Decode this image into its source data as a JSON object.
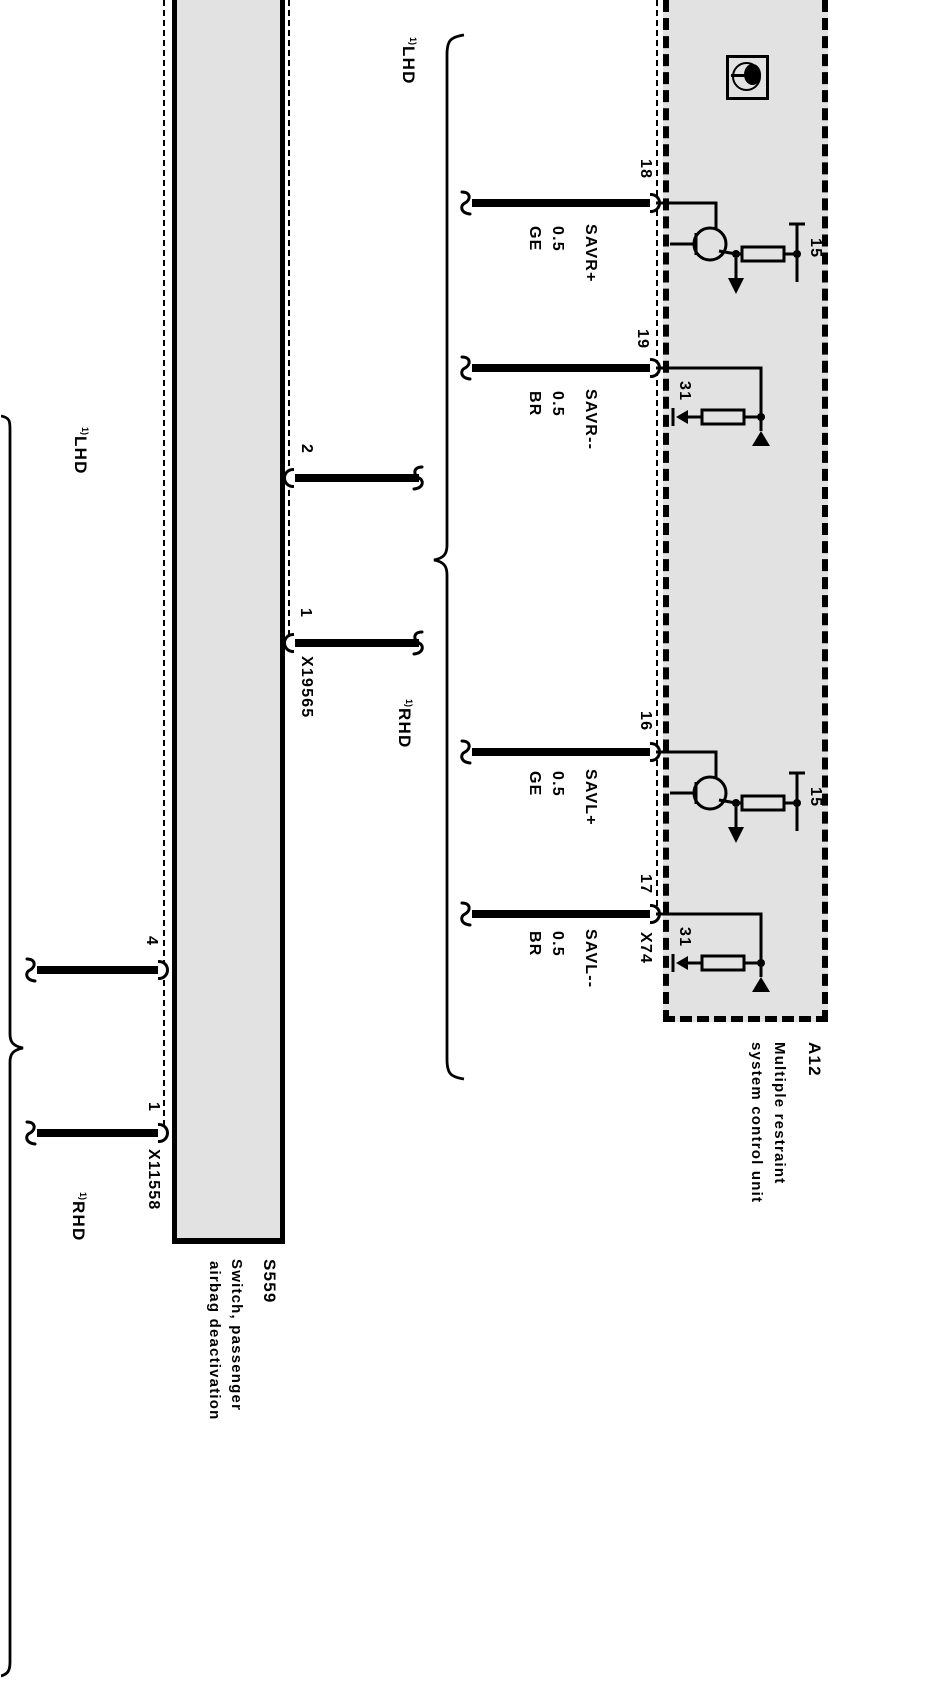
{
  "colors": {
    "background": "#ffffff",
    "component_fill": "#e2e2e2",
    "line": "#000000"
  },
  "variants": {
    "lhd": "LHD",
    "rhd": "RHD",
    "footnote": "1)"
  },
  "control_unit": {
    "id": "A12",
    "description_line1": "Multiple restraint",
    "description_line2": "system control unit",
    "connector": "X74",
    "pins": {
      "p18": "18",
      "p19": "19",
      "p16": "16",
      "p17": "17"
    },
    "terminal_15": "15",
    "terminal_31": "31"
  },
  "switch": {
    "id": "S559",
    "description_line1": "Switch, passenger",
    "description_line2": "airbag deactivation",
    "connector_right": "X19565",
    "connector_left": "X11558",
    "pins_right": {
      "p2": "2",
      "p1": "1"
    },
    "pins_left": {
      "p4": "4",
      "p1": "1"
    }
  },
  "wires": [
    {
      "pin": "18",
      "name": "SAVR+",
      "size": "0.5",
      "color": "GE"
    },
    {
      "pin": "19",
      "name": "SAVR--",
      "size": "0.5",
      "color": "BR"
    },
    {
      "pin": "16",
      "name": "SAVL+",
      "size": "0.5",
      "color": "GE"
    },
    {
      "pin": "17",
      "name": "SAVL--",
      "size": "0.5",
      "color": "BR"
    }
  ]
}
